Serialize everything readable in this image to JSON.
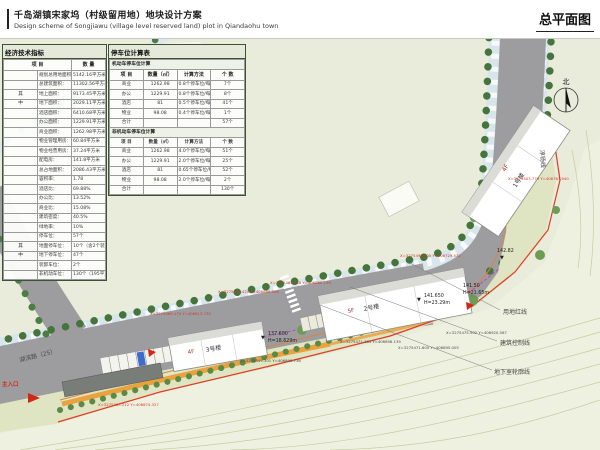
{
  "header": {
    "title_cn": "千岛湖镇宋家坞（村级留用地）地块设计方案",
    "title_en": "Design scheme of Songjiawu (village level reserved land) plot in Qiandaohu town",
    "sheet_title": "总平面图"
  },
  "econ_table": {
    "title": "经济技术指标",
    "col_item": "项  目",
    "col_qty": "数  量",
    "rows": [
      {
        "g": "",
        "label": "规划总用地面积：",
        "value": "5142.16平方米"
      },
      {
        "g": "",
        "label": "总建筑面积：",
        "value": "11302.56平方米"
      },
      {
        "g": "其",
        "label": "地上面积：",
        "value": "9173.45平方米"
      },
      {
        "g": "中",
        "label": "地下面积：",
        "value": "2029.11平方米"
      },
      {
        "g": "",
        "label": "酒店面积：",
        "value": "6410.68平方米"
      },
      {
        "g": "",
        "label": "办公面积：",
        "value": "1229.91平方米"
      },
      {
        "g": "",
        "label": "商业面积：",
        "value": "1262.98平方米"
      },
      {
        "g": "",
        "label": "物业管理用房：",
        "value": "60.84平方米"
      },
      {
        "g": "",
        "label": "物业经营用房：",
        "value": "37.24平方米"
      },
      {
        "g": "",
        "label": "配电房：",
        "value": "141.8平方米"
      },
      {
        "g": "",
        "label": "总占地面积：",
        "value": "2086.43平方米"
      },
      {
        "g": "",
        "label": "容积率：",
        "value": "1.78"
      },
      {
        "g": "",
        "label": "酒店比：",
        "value": "69.88%"
      },
      {
        "g": "",
        "label": "办公比：",
        "value": "13.52%"
      },
      {
        "g": "",
        "label": "商业比：",
        "value": "15.08%"
      },
      {
        "g": "",
        "label": "建筑密度：",
        "value": "40.5%"
      },
      {
        "g": "",
        "label": "绿地率：",
        "value": "10%"
      },
      {
        "g": "",
        "label": "停车位：",
        "value": "57个"
      },
      {
        "g": "其",
        "label": "地面停车位：",
        "value": "10个（含2个装卸车位）"
      },
      {
        "g": "中",
        "label": "地下停车位：",
        "value": "47个"
      },
      {
        "g": "",
        "label": "装卸车位：",
        "value": "2个"
      },
      {
        "g": "",
        "label": "非机动车位：",
        "value": "130个（195平方米）"
      }
    ]
  },
  "parking_table": {
    "title": "停车位计算表",
    "motor_section": "机动车停车位计算",
    "nonmotor_section": "非机动车停车位计算",
    "col_item": "项 目",
    "col_qty": "数量（㎡）",
    "col_method": "计算方法",
    "col_count": "个 数",
    "motor_rows": [
      [
        "商业",
        "1262.98",
        "0.8个停车位/每100㎡建筑面积",
        "7个"
      ],
      [
        "办公",
        "1229.91",
        "0.8个停车位/每100㎡建筑面积",
        "8个"
      ],
      [
        "酒店",
        "81",
        "0.5个停车位/每间",
        "41个"
      ],
      [
        "物业",
        "98.08",
        "0.4个停车位/每户",
        "1个"
      ],
      [
        "合计",
        "",
        "",
        "57个"
      ]
    ],
    "nonmotor_rows": [
      [
        "商业",
        "1262.98",
        "4.0个停车位/每100㎡建筑面积",
        "51个"
      ],
      [
        "办公",
        "1229.91",
        "2.0个停车位/每100㎡建筑面积",
        "25个"
      ],
      [
        "酒店",
        "81",
        "0.65个停车位/每间",
        "52个"
      ],
      [
        "物业",
        "98.08",
        "2.0个停车位/每100㎡建筑面积",
        "2个"
      ],
      [
        "合计",
        "",
        "",
        "130个"
      ]
    ]
  },
  "map": {
    "compass_label": "北",
    "road_1": "湖滨路（25）",
    "road_2": "淳杨线",
    "entrance_label": "主入口",
    "boundary_labels": {
      "red_line": "用地红线",
      "control_line": "建筑控制线",
      "basement_line": "地下室轮廓线"
    },
    "buildings": {
      "b1_name": "1号楼",
      "b1_floors": "4F",
      "b2_name": "2号楼",
      "b2_floors": "5F",
      "b3_name": "3号楼",
      "b3_floors": "4F"
    },
    "spots": {
      "marker_glyph": "▼",
      "s1": "142.82",
      "s2": "141.650",
      "s2h": "H=23.29m",
      "s3": "137.600",
      "s3h": "H=18.629m",
      "s4": "141.50",
      "s4h": "H=21.65m"
    },
    "coords": [
      "X=3275503.779 Y=406767.940",
      "X=3275494.100 Y=406729.532",
      "X=3275481.458 Y=406880.139",
      "X=3275476.420 Y=406850.308",
      "X=3275460.174 Y=406813.730",
      "X=3275465.212 Y=406874.327",
      "X=3275471.485 Y=406898.139",
      "X=3275471.605 Y=406895.005",
      "X=3275475.502 Y=406920.567",
      "X=3275449.301 Y=406890.738"
    ]
  }
}
